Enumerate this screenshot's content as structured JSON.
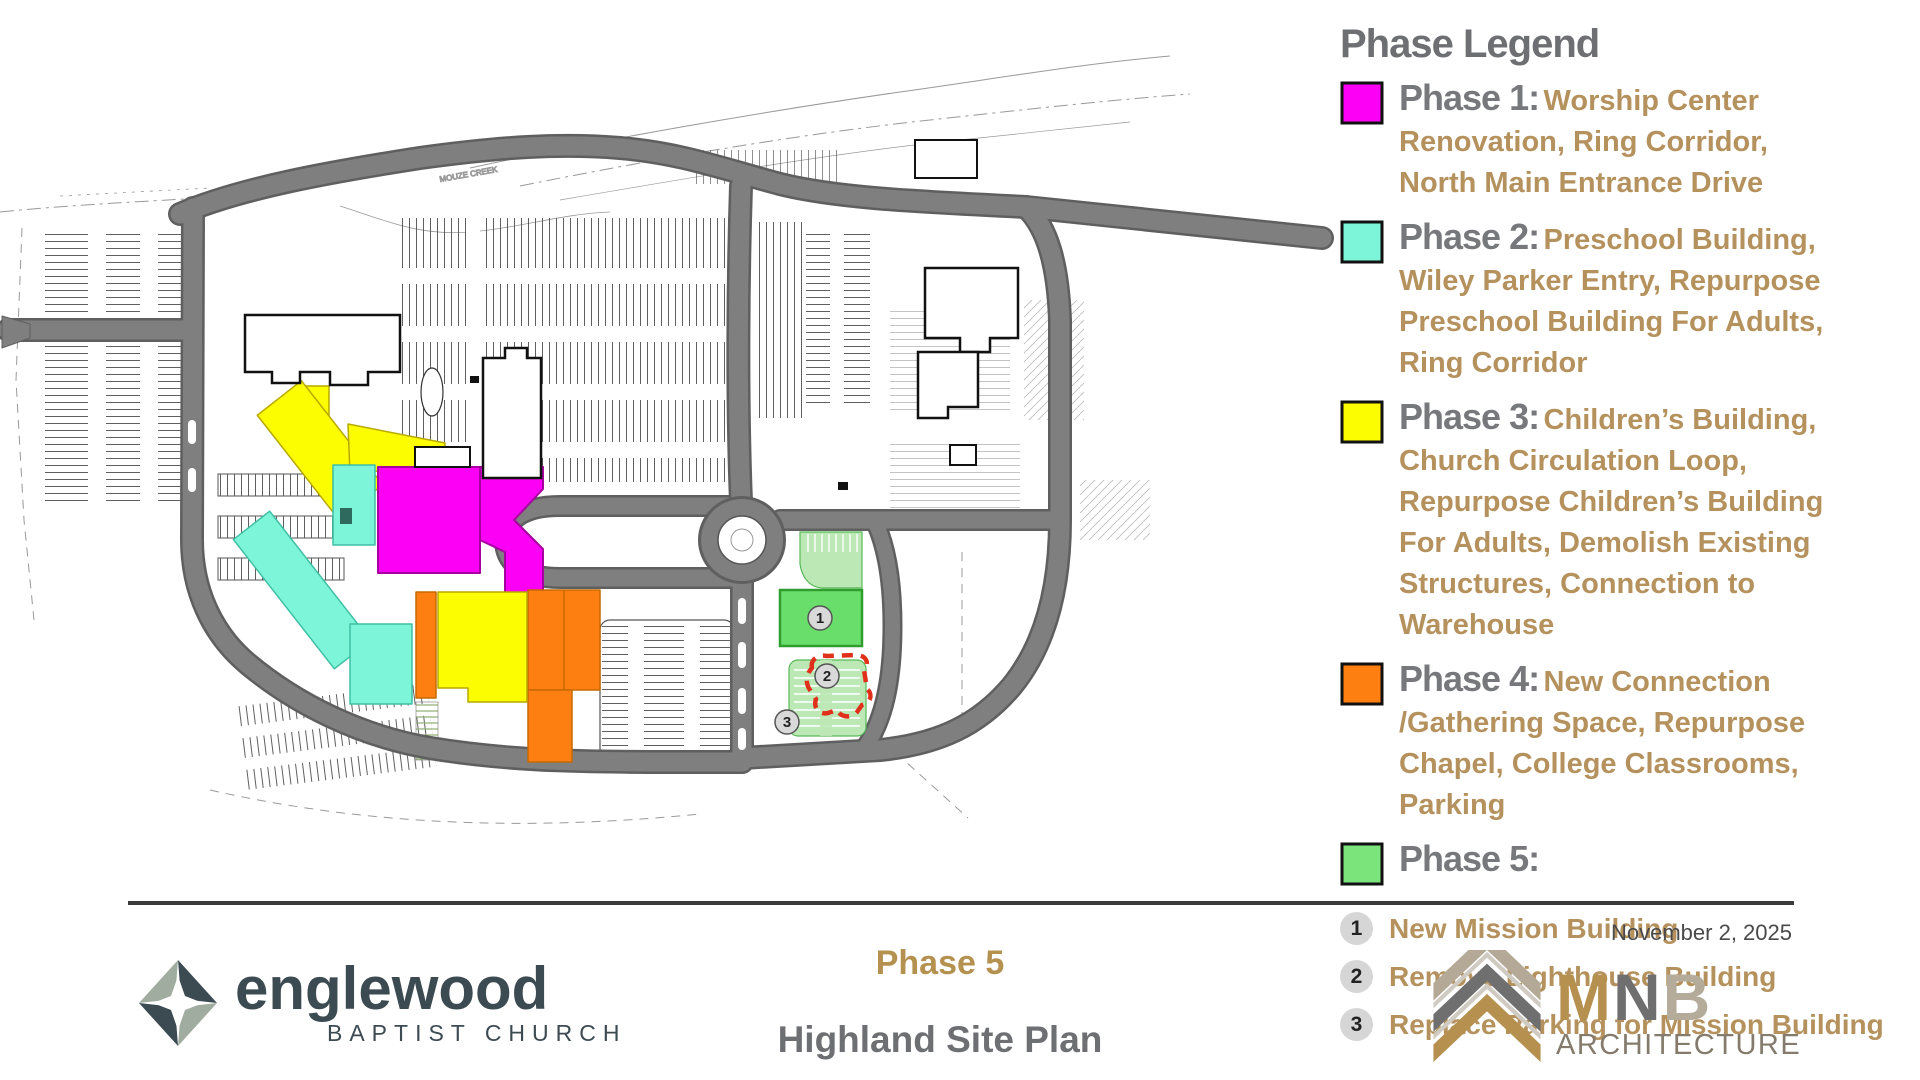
{
  "legend": {
    "title": "Phase Legend",
    "phases": [
      {
        "label": "Phase 1:",
        "description": "Worship Center Renovation, Ring Corridor, North Main Entrance Drive",
        "color": "#fb00f5"
      },
      {
        "label": "Phase 2:",
        "description": "Preschool Building, Wiley Parker Entry, Repurpose Preschool Building For Adults, Ring Corridor",
        "color": "#7df5d8"
      },
      {
        "label": "Phase 3:",
        "description": "Children’s Building, Church Circulation Loop, Repurpose Children’s Building For Adults, Demolish Existing Structures, Connection to Warehouse",
        "color": "#fdfd02"
      },
      {
        "label": "Phase 4:",
        "description": "New Connection /Gathering Space, Repurpose Chapel, College Classrooms, Parking",
        "color": "#fd7f11"
      },
      {
        "label": "Phase 5:",
        "description": "",
        "color": "#7be47b"
      }
    ],
    "notes": [
      {
        "num": "1",
        "text": "New Mission Building"
      },
      {
        "num": "2",
        "text": "Remove Lighthouse Building"
      },
      {
        "num": "3",
        "text": "Replace Parking for Mission Building"
      }
    ]
  },
  "plan": {
    "creek_label": "MOUZE CREEK",
    "markers": [
      {
        "num": "1"
      },
      {
        "num": "2"
      },
      {
        "num": "3"
      }
    ],
    "colors": {
      "phase1": "#fb00f5",
      "phase2": "#7df5d8",
      "phase3": "#fdfd02",
      "phase4": "#fd7f11",
      "phase5": "#6ade6a",
      "phase5_light": "#bce8b6",
      "road": "#7f7f7f",
      "demolish_outline": "#e0301a"
    }
  },
  "footer": {
    "date": "November 2, 2025",
    "phase_title": "Phase 5",
    "plan_title": "Highland Site Plan",
    "englewood": {
      "name": "englewood",
      "tagline": "BAPTIST CHURCH"
    },
    "mnb": {
      "letters": [
        "M",
        "N",
        "B"
      ],
      "tagline": "ARCHITECTURE"
    }
  }
}
